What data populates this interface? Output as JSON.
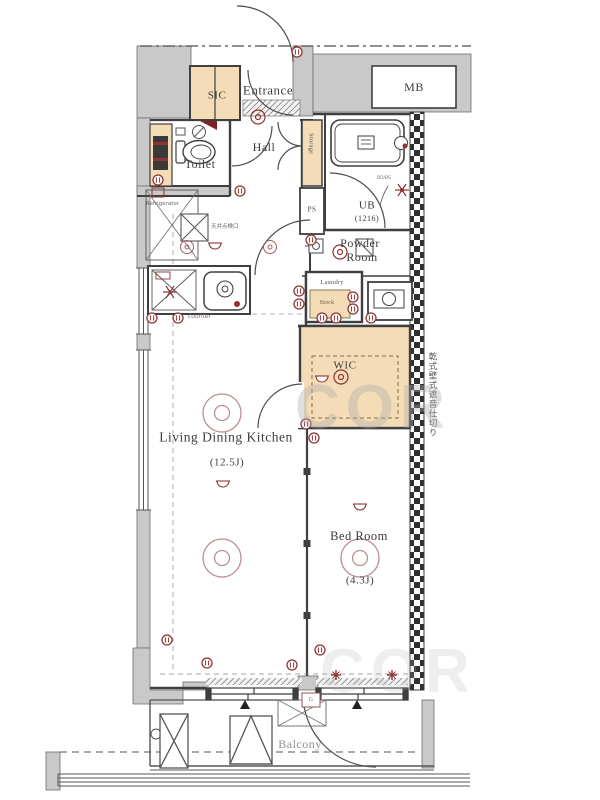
{
  "plan_title": "apartment-floor-plan",
  "rooms": {
    "entrance": {
      "label": "Entrance"
    },
    "sic": {
      "label": "SIC"
    },
    "mb": {
      "label": "MB"
    },
    "toilet": {
      "label": "Toilet"
    },
    "hall": {
      "label": "Hall"
    },
    "storage": {
      "label": "Storage"
    },
    "ub": {
      "label": "UB",
      "size": "(1216)"
    },
    "ps": {
      "label": "PS"
    },
    "powder": {
      "line1": "Powder",
      "line2": "Room"
    },
    "laundry": {
      "label": "Laundry",
      "sub": "Stock"
    },
    "wic": {
      "label": "WIC"
    },
    "ldk": {
      "label": "Living Dining Kitchen",
      "size": "(12.5J)"
    },
    "bedroom": {
      "label": "Bed Room",
      "size": "(4.3J)"
    },
    "balcony": {
      "label": "Balcony"
    }
  },
  "annotations": {
    "partition_note": "乾式壁式遮音仕切り",
    "refrigerator": "Refrigerator",
    "ceiling_hatch": "天井点検口",
    "counter_note": "counter",
    "gas_meter": "G",
    "bath_note": "BD/BS"
  },
  "watermark": "COR",
  "colors": {
    "wall_gray": "#c9c9c9",
    "fixture_tan": "#f4dcb6",
    "line": "#3f3f3f",
    "symbol_red": "#8e3434",
    "balcony_label": "#909090"
  }
}
